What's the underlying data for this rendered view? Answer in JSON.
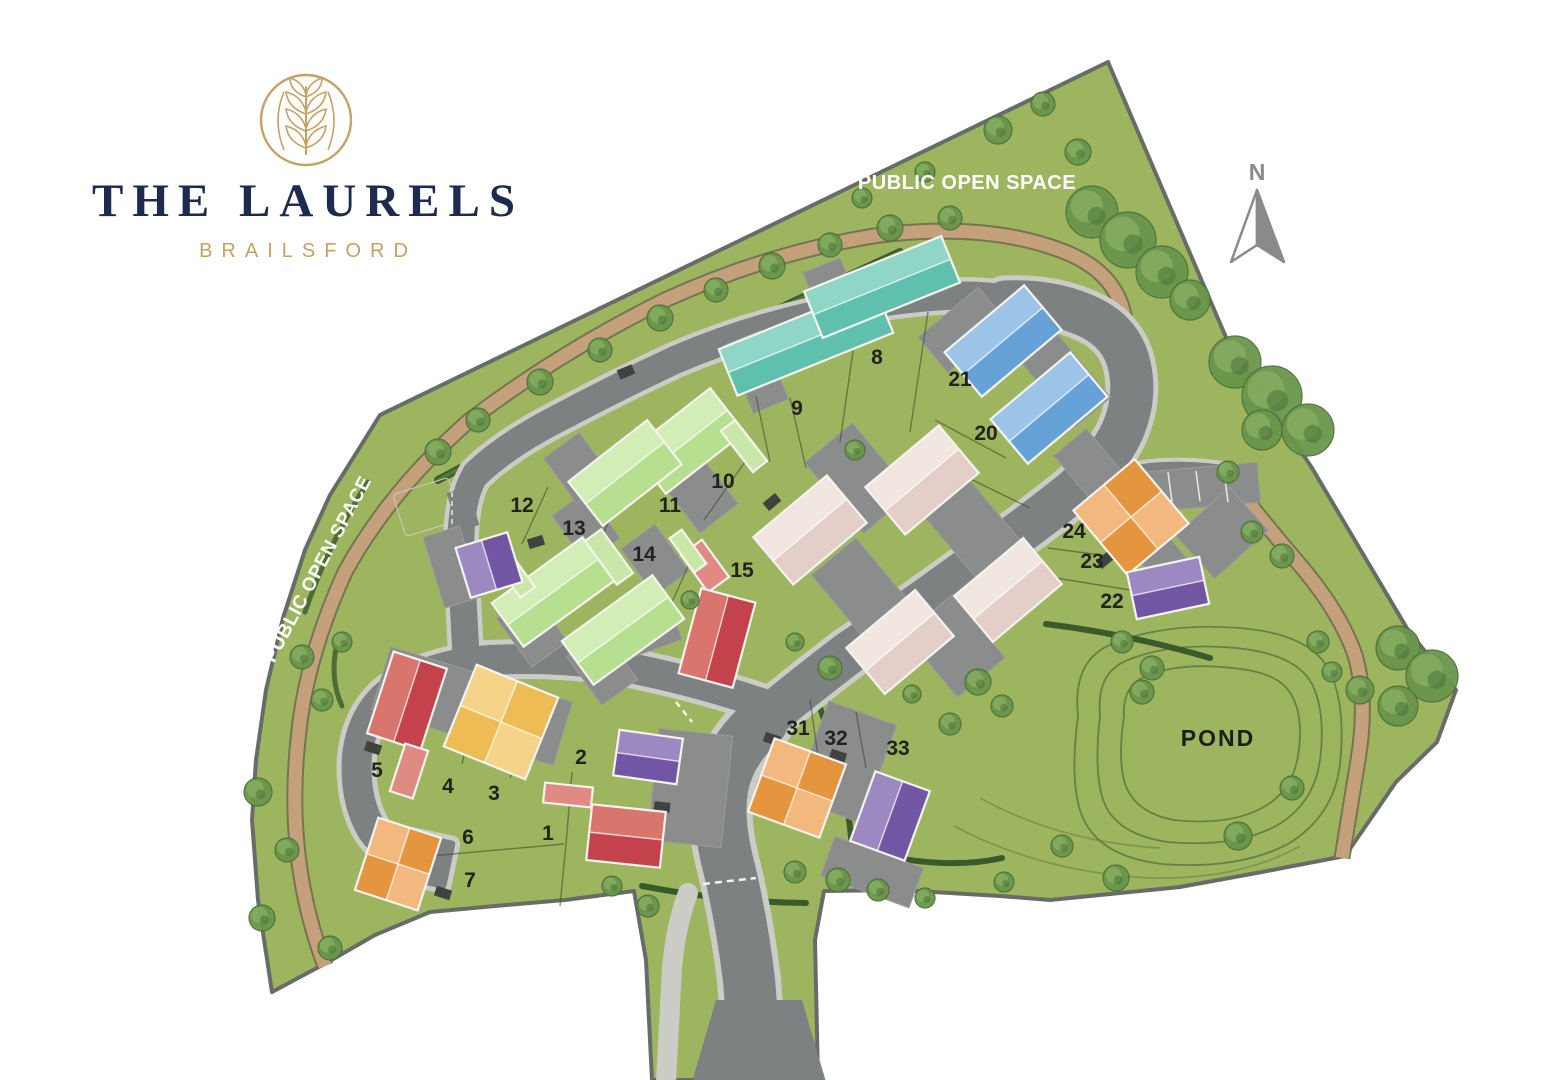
{
  "brand": {
    "title": "THE LAURELS",
    "subtitle": "BRAILSFORD",
    "emblem": "laurel-leaf-circle"
  },
  "compass": {
    "north_label": "N"
  },
  "labels": {
    "public_open_space_top": "PUBLIC OPEN SPACE",
    "public_open_space_left": "PUBLIC OPEN SPACE",
    "pond": "POND"
  },
  "colors": {
    "site_green": "#9db55e",
    "road": "#7e8181",
    "footpath": "#cbccc5",
    "drive": "#8b8d8c",
    "path_tan": "#c4a17b",
    "path_tan_edge": "#6f6a50",
    "boundary": "#686c69",
    "hedge_dark": "#3a5a2b",
    "hedge_light": "#527a38",
    "contour": "#5c7a40",
    "tree_dark": "#4d7238",
    "tree_mid": "#6a954c",
    "tree_light": "#84ac5f",
    "house_outline": "#f4f3ef",
    "brand_navy": "#1e2b4f",
    "brand_gold": "#c3a266",
    "label_dark": "#222220",
    "compass_gray": "#8a8a8a",
    "houses": {
      "teal": [
        "#8fd6c6",
        "#5fc0ae"
      ],
      "green": [
        "#d3edb6",
        "#b7df90"
      ],
      "blue": [
        "#9cc3e8",
        "#66a1d8"
      ],
      "beige": [
        "#f2e6e1",
        "#e3cfc8"
      ],
      "orange": [
        "#f2b87e",
        "#e6953f"
      ],
      "purple": [
        "#9d89c1",
        "#7157a3"
      ],
      "red": [
        "#d8766e",
        "#c4424c"
      ],
      "yellow": [
        "#f5d489",
        "#eebc55"
      ],
      "redlight": [
        "#e08a84",
        "#e08a84"
      ]
    }
  },
  "plots": [
    {
      "number": "1",
      "x": 548,
      "y": 840
    },
    {
      "number": "2",
      "x": 581,
      "y": 764
    },
    {
      "number": "3",
      "x": 494,
      "y": 800
    },
    {
      "number": "4",
      "x": 448,
      "y": 793
    },
    {
      "number": "5",
      "x": 377,
      "y": 777
    },
    {
      "number": "6",
      "x": 468,
      "y": 844
    },
    {
      "number": "7",
      "x": 470,
      "y": 887
    },
    {
      "number": "8",
      "x": 877,
      "y": 364
    },
    {
      "number": "9",
      "x": 797,
      "y": 415
    },
    {
      "number": "10",
      "x": 723,
      "y": 488
    },
    {
      "number": "11",
      "x": 670,
      "y": 512
    },
    {
      "number": "12",
      "x": 522,
      "y": 512
    },
    {
      "number": "13",
      "x": 574,
      "y": 535
    },
    {
      "number": "14",
      "x": 644,
      "y": 561
    },
    {
      "number": "15",
      "x": 742,
      "y": 577
    },
    {
      "number": "20",
      "x": 986,
      "y": 440
    },
    {
      "number": "21",
      "x": 960,
      "y": 386
    },
    {
      "number": "22",
      "x": 1112,
      "y": 608
    },
    {
      "number": "23",
      "x": 1092,
      "y": 568
    },
    {
      "number": "24",
      "x": 1074,
      "y": 538
    },
    {
      "number": "31",
      "x": 798,
      "y": 735
    },
    {
      "number": "32",
      "x": 836,
      "y": 745
    },
    {
      "number": "33",
      "x": 898,
      "y": 755
    }
  ],
  "houses": [
    {
      "id": "terrace-8-9-a",
      "cx": 806,
      "cy": 341,
      "w": 168,
      "h": 50,
      "a": -22,
      "c": "teal",
      "split": "h"
    },
    {
      "id": "terrace-8-9-b",
      "cx": 882,
      "cy": 287,
      "w": 148,
      "h": 50,
      "a": -22,
      "c": "teal",
      "split": "h"
    },
    {
      "id": "house-10",
      "cx": 688,
      "cy": 441,
      "w": 100,
      "h": 56,
      "a": -38,
      "c": "green",
      "split": "h"
    },
    {
      "id": "house-11",
      "cx": 625,
      "cy": 473,
      "w": 100,
      "h": 56,
      "a": -38,
      "c": "green",
      "split": "h"
    },
    {
      "id": "garage-10",
      "cx": 744,
      "cy": 446,
      "w": 18,
      "h": 52,
      "a": -38,
      "c": "green",
      "split": "none"
    },
    {
      "id": "house-13",
      "cx": 553,
      "cy": 592,
      "w": 112,
      "h": 54,
      "a": -36,
      "c": "green",
      "split": "h"
    },
    {
      "id": "house-14",
      "cx": 623,
      "cy": 630,
      "w": 112,
      "h": 54,
      "a": -36,
      "c": "green",
      "split": "h"
    },
    {
      "id": "garage-14",
      "cx": 609,
      "cy": 557,
      "w": 20,
      "h": 54,
      "a": -36,
      "c": "green",
      "split": "none"
    },
    {
      "id": "garage-13",
      "cx": 513,
      "cy": 572,
      "w": 18,
      "h": 50,
      "a": -36,
      "c": "green",
      "split": "none"
    },
    {
      "id": "house-12",
      "cx": 489,
      "cy": 565,
      "w": 54,
      "h": 52,
      "a": -17,
      "c": "purple",
      "split": "w"
    },
    {
      "id": "garage-15-red",
      "cx": 705,
      "cy": 566,
      "w": 26,
      "h": 46,
      "a": -36,
      "c": "redlight",
      "split": "none"
    },
    {
      "id": "garage-15-grn",
      "cx": 688,
      "cy": 551,
      "w": 15,
      "h": 42,
      "a": -36,
      "c": "green",
      "split": "none"
    },
    {
      "id": "house-15",
      "cx": 717,
      "cy": 638,
      "w": 56,
      "h": 88,
      "a": 15,
      "c": "red",
      "split": "w"
    },
    {
      "id": "house-21",
      "cx": 1003,
      "cy": 341,
      "w": 104,
      "h": 58,
      "a": -40,
      "c": "blue",
      "split": "h"
    },
    {
      "id": "house-20",
      "cx": 1049,
      "cy": 408,
      "w": 104,
      "h": 58,
      "a": -40,
      "c": "blue",
      "split": "h"
    },
    {
      "id": "house-beige-a",
      "cx": 810,
      "cy": 530,
      "w": 96,
      "h": 62,
      "a": -40,
      "c": "beige",
      "split": "h"
    },
    {
      "id": "house-beige-b",
      "cx": 922,
      "cy": 480,
      "w": 96,
      "h": 62,
      "a": -40,
      "c": "beige",
      "split": "h"
    },
    {
      "id": "house-beige-c",
      "cx": 1008,
      "cy": 590,
      "w": 90,
      "h": 60,
      "a": -40,
      "c": "beige",
      "split": "h"
    },
    {
      "id": "house-beige-d",
      "cx": 900,
      "cy": 642,
      "w": 90,
      "h": 60,
      "a": -40,
      "c": "beige",
      "split": "h"
    },
    {
      "id": "house-24",
      "cx": 1131,
      "cy": 517,
      "w": 80,
      "h": 84,
      "a": -40,
      "c": "orange",
      "split": "quad"
    },
    {
      "id": "house-22",
      "cx": 1168,
      "cy": 588,
      "w": 74,
      "h": 48,
      "a": -12,
      "c": "purple",
      "split": "h"
    },
    {
      "id": "house-31-32",
      "cx": 797,
      "cy": 788,
      "w": 76,
      "h": 78,
      "a": 20,
      "c": "orange",
      "split": "quad"
    },
    {
      "id": "house-33",
      "cx": 890,
      "cy": 816,
      "w": 58,
      "h": 74,
      "a": 20,
      "c": "purple",
      "split": "w"
    },
    {
      "id": "house-5",
      "cx": 407,
      "cy": 701,
      "w": 56,
      "h": 86,
      "a": 18,
      "c": "red",
      "split": "w"
    },
    {
      "id": "garage-5",
      "cx": 409,
      "cy": 771,
      "w": 24,
      "h": 50,
      "a": 18,
      "c": "redlight",
      "split": "none"
    },
    {
      "id": "house-3-4",
      "cx": 501,
      "cy": 722,
      "w": 88,
      "h": 88,
      "a": 22,
      "c": "yellow",
      "split": "quad"
    },
    {
      "id": "house-2",
      "cx": 648,
      "cy": 757,
      "w": 64,
      "h": 46,
      "a": 8,
      "c": "purple",
      "split": "h"
    },
    {
      "id": "garage-1",
      "cx": 568,
      "cy": 795,
      "w": 48,
      "h": 20,
      "a": 6,
      "c": "redlight",
      "split": "none"
    },
    {
      "id": "house-1",
      "cx": 626,
      "cy": 836,
      "w": 74,
      "h": 56,
      "a": 6,
      "c": "red",
      "split": "h"
    },
    {
      "id": "house-7",
      "cx": 398,
      "cy": 864,
      "w": 66,
      "h": 76,
      "a": 18,
      "c": "orange",
      "split": "quad"
    }
  ],
  "trees": [
    [
      438,
      452,
      13
    ],
    [
      478,
      420,
      12
    ],
    [
      540,
      382,
      13
    ],
    [
      600,
      350,
      12
    ],
    [
      660,
      318,
      13
    ],
    [
      716,
      290,
      12
    ],
    [
      772,
      266,
      13
    ],
    [
      830,
      245,
      12
    ],
    [
      890,
      228,
      13
    ],
    [
      950,
      218,
      12
    ],
    [
      998,
      130,
      14
    ],
    [
      1043,
      104,
      12
    ],
    [
      1078,
      152,
      13
    ],
    [
      925,
      172,
      10
    ],
    [
      862,
      198,
      10
    ],
    [
      1092,
      212,
      26
    ],
    [
      1128,
      240,
      28
    ],
    [
      1162,
      272,
      26
    ],
    [
      1190,
      300,
      20
    ],
    [
      1235,
      362,
      26
    ],
    [
      1272,
      396,
      30
    ],
    [
      1308,
      430,
      26
    ],
    [
      1262,
      430,
      20
    ],
    [
      1398,
      648,
      22
    ],
    [
      1432,
      676,
      26
    ],
    [
      1398,
      706,
      20
    ],
    [
      1360,
      690,
      14
    ],
    [
      1228,
      472,
      11
    ],
    [
      1252,
      532,
      11
    ],
    [
      1282,
      556,
      12
    ],
    [
      1318,
      642,
      11
    ],
    [
      1332,
      672,
      10
    ],
    [
      1122,
      642,
      11
    ],
    [
      1152,
      668,
      12
    ],
    [
      1142,
      692,
      12
    ],
    [
      1238,
      836,
      14
    ],
    [
      1292,
      788,
      12
    ],
    [
      1116,
      878,
      13
    ],
    [
      1062,
      846,
      11
    ],
    [
      1004,
      882,
      10
    ],
    [
      950,
      724,
      11
    ],
    [
      912,
      694,
      9
    ],
    [
      978,
      682,
      13
    ],
    [
      1002,
      706,
      11
    ],
    [
      795,
      872,
      11
    ],
    [
      838,
      880,
      12
    ],
    [
      878,
      890,
      11
    ],
    [
      925,
      898,
      10
    ],
    [
      612,
      886,
      10
    ],
    [
      648,
      906,
      11
    ],
    [
      302,
      657,
      12
    ],
    [
      322,
      700,
      11
    ],
    [
      258,
      792,
      14
    ],
    [
      287,
      850,
      12
    ],
    [
      262,
      918,
      13
    ],
    [
      330,
      948,
      12
    ],
    [
      342,
      642,
      10
    ],
    [
      830,
      668,
      12
    ],
    [
      795,
      642,
      9
    ],
    [
      855,
      450,
      10
    ],
    [
      690,
      600,
      9
    ]
  ]
}
